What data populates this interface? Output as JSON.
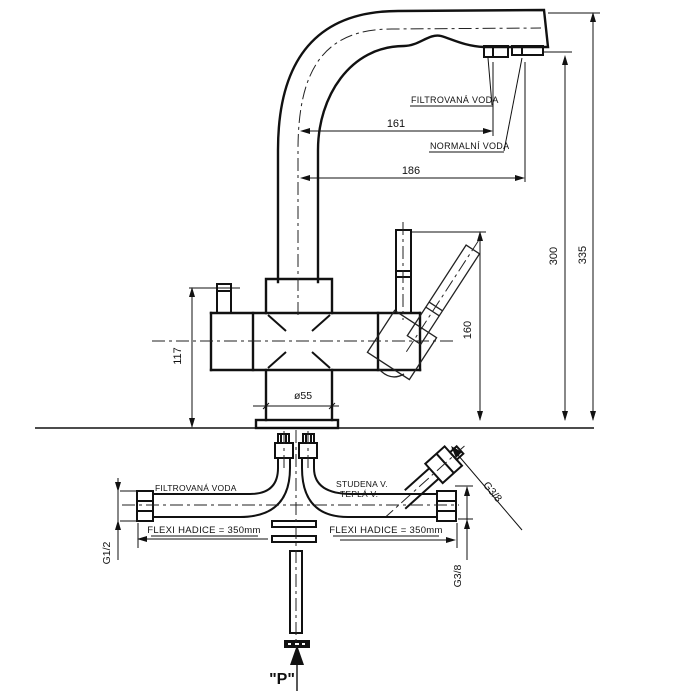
{
  "meta": {
    "title": "Kitchen faucet technical drawing",
    "units": "mm"
  },
  "colors": {
    "line": "#111111",
    "background": "#ffffff"
  },
  "labels": {
    "filtered_water_top": "FILTROVANÁ VODA",
    "normal_water": "NORMALNÍ VODA",
    "filtered_water_bottom": "FILTROVANÁ VODA",
    "cold_water": "STUDENA V.",
    "hot_water": "TEPLÁ V.",
    "flexi_hose_left": "FLEXI HADICE = 350mm",
    "flexi_hose_right": "FLEXI HADICE = 350mm",
    "thread_left": "G1/2",
    "thread_bottom_right": "G3/8",
    "thread_angled": "G3/8",
    "pressure_point": "\"P\""
  },
  "dimensions": {
    "reach_filtered": "161",
    "reach_normal": "186",
    "height_outlet": "300",
    "height_total": "335",
    "height_handle": "160",
    "height_body": "117",
    "base_diameter": "ø55"
  }
}
